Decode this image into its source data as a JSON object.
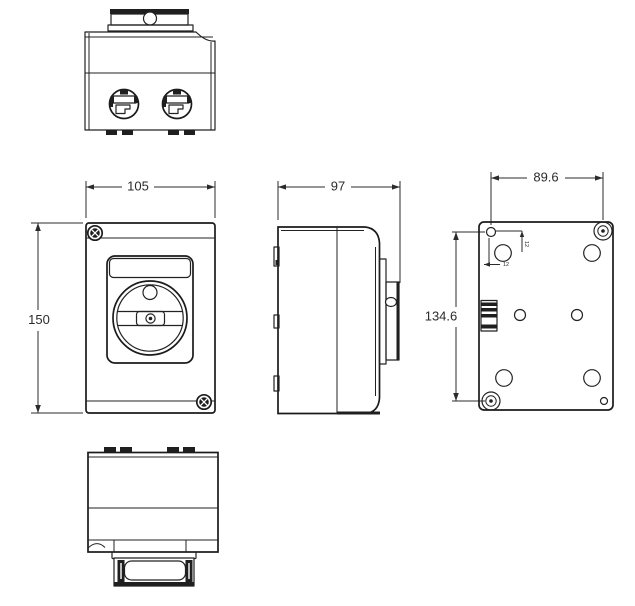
{
  "drawing": {
    "type": "orthographic-technical-drawing",
    "views": [
      "top",
      "front",
      "side",
      "back",
      "bottom"
    ],
    "dimensions": {
      "front_width": "105",
      "front_height": "150",
      "side_depth": "97",
      "back_mount_width": "89.6",
      "back_mount_height": "134.6",
      "back_hole_offset_v": "12",
      "back_hole_offset_h": "12"
    },
    "colors": {
      "line": "#222222",
      "text": "#2b2b2b",
      "background": "#ffffff"
    }
  }
}
